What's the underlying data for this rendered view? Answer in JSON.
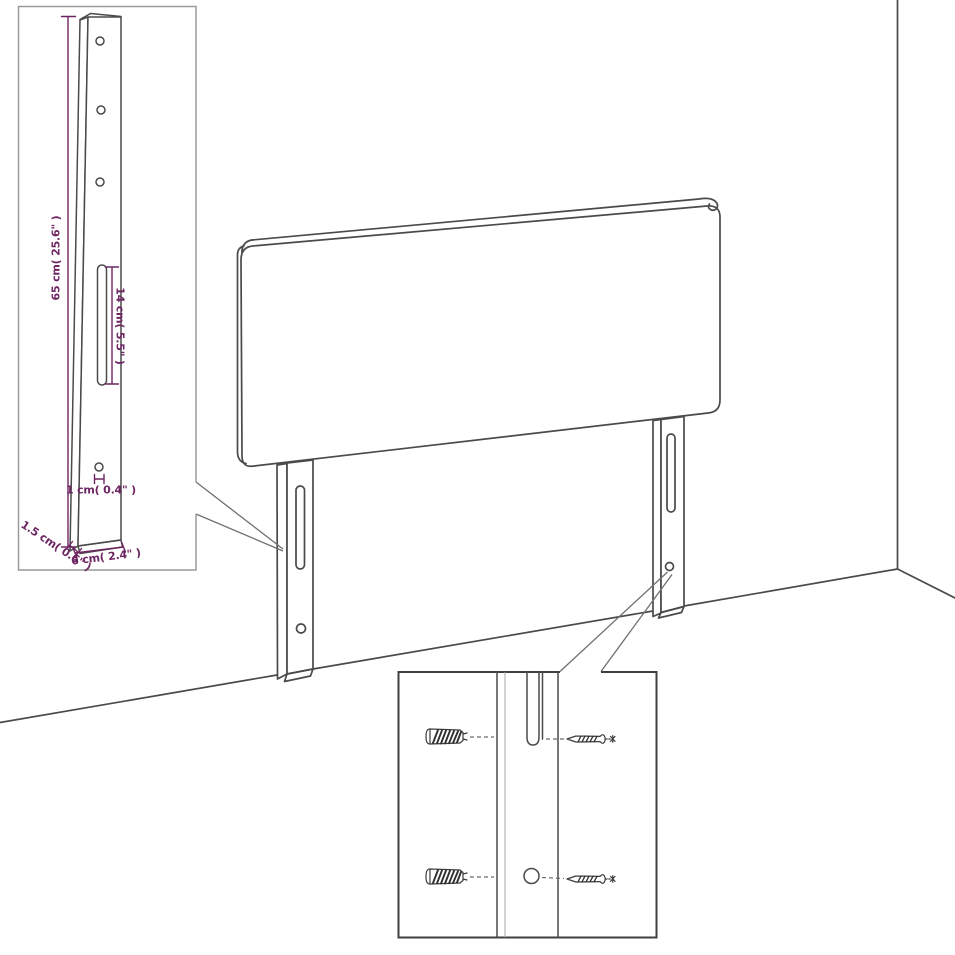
{
  "colors": {
    "background": "#ffffff",
    "line": "#4a4a4a",
    "dimension": "#6e2663"
  },
  "insets": {
    "leg_detail": {
      "dims": {
        "leg_height": "65 cm( 25.6\" )",
        "slot_length": "14 cm( 5.5\" )",
        "hole_diameter": "1 cm( 0.4\" )",
        "leg_thickness": "1.5 cm( 0.6\" )",
        "leg_width": "6 cm( 2.4\" )"
      }
    }
  }
}
